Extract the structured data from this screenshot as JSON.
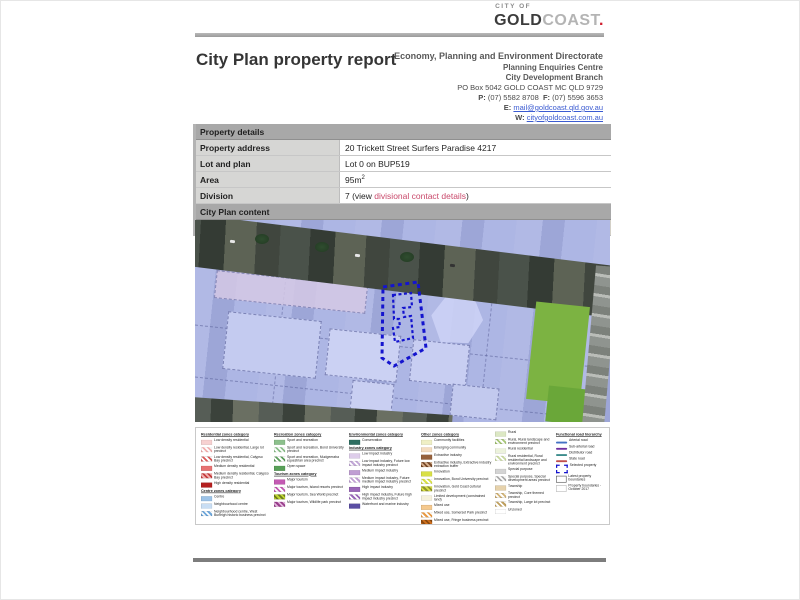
{
  "logo": {
    "city_of": "CITY OF",
    "gold": "GOLD",
    "coast": "COAST",
    "dot": "."
  },
  "header": {
    "title": "City Plan property report",
    "directorate": "Economy, Planning and Environment Directorate",
    "centre": "Planning Enquiries Centre",
    "branch": "City Development Branch",
    "po_box": "PO Box 5042 GOLD COAST MC QLD 9729",
    "phone_label": "P:",
    "phone": "(07) 5582 8708",
    "fax_label": "F:",
    "fax": "(07) 5596 3653",
    "email_label": "E:",
    "email": "mail@goldcoast.qld.gov.au",
    "web_label": "W:",
    "web": "cityofgoldcoast.com.au"
  },
  "property_details": {
    "section_title": "Property details",
    "rows": [
      {
        "label": "Property address",
        "value": "20 Trickett Street Surfers Paradise 4217"
      },
      {
        "label": "Lot and plan",
        "value": "Lot 0 on BUP519"
      },
      {
        "label": "Area",
        "value": "95m",
        "sup": "2"
      },
      {
        "label": "Division",
        "prefix": "7 (view ",
        "link": "divisional contact details",
        "suffix": ")"
      }
    ]
  },
  "sections": {
    "city_plan_content": "City Plan content",
    "zone_map": "Zone map"
  },
  "map_colors": {
    "zone_overlay": "#A8B1E2",
    "open_space_green": "#7CB342",
    "selected_property_outline": "#1414CE",
    "aerial_road": "#3B423B"
  },
  "legend": {
    "columns": [
      {
        "sections": [
          {
            "header": "Residential zones category",
            "items": [
              {
                "label": "Low density residential",
                "swatch": {
                  "type": "solid",
                  "color": "#F7D1D1"
                }
              },
              {
                "label": "Low density residential, Large lot precinct",
                "swatch": {
                  "type": "stripes",
                  "color": "#F2B0B0",
                  "color2": "#FFFFFF"
                }
              },
              {
                "label": "Low density residential, Calypso Bay precinct",
                "swatch": {
                  "type": "stripes",
                  "color": "#D85A5A",
                  "color2": "#FFFFFF"
                }
              },
              {
                "label": "Medium density residential",
                "swatch": {
                  "type": "solid",
                  "color": "#E87272"
                }
              },
              {
                "label": "Medium density residential, Calypso Bay precinct",
                "swatch": {
                  "type": "stripes",
                  "color": "#C43F3F",
                  "color2": "#F3B0B0"
                }
              },
              {
                "label": "High density residential",
                "swatch": {
                  "type": "solid",
                  "color": "#B42020"
                }
              }
            ]
          },
          {
            "header": "Centre zones category",
            "items": [
              {
                "label": "Centre",
                "swatch": {
                  "type": "solid",
                  "color": "#9CC3E8"
                }
              },
              {
                "label": "Neighbourhood centre",
                "swatch": {
                  "type": "solid",
                  "color": "#C9DEF4"
                }
              },
              {
                "label": "Neighbourhood centre, West Burleigh historic business precinct",
                "swatch": {
                  "type": "stripes",
                  "color": "#6FA8DC",
                  "color2": "#FFFFFF"
                }
              }
            ]
          }
        ]
      },
      {
        "sections": [
          {
            "header": "Recreation zones category",
            "items": [
              {
                "label": "Sport and recreation",
                "swatch": {
                  "type": "solid",
                  "color": "#8CC08C"
                }
              },
              {
                "label": "Sport and recreation, Bond University precinct",
                "swatch": {
                  "type": "stripes",
                  "color": "#8CC08C",
                  "color2": "#FFFFFF"
                }
              },
              {
                "label": "Sport and recreation, Mudgeeraba equestrian area precinct",
                "swatch": {
                  "type": "stripes",
                  "color": "#5E9E5E",
                  "color2": "#FFFFFF"
                }
              },
              {
                "label": "Open space",
                "swatch": {
                  "type": "solid",
                  "color": "#58A058"
                }
              }
            ]
          },
          {
            "header": "Tourism zones category",
            "items": [
              {
                "label": "Major tourism",
                "swatch": {
                  "type": "solid",
                  "color": "#C45AB3"
                }
              },
              {
                "label": "Major tourism, Island resorts precinct",
                "swatch": {
                  "type": "stripes",
                  "color": "#C45AB3",
                  "color2": "#FFFFFF"
                }
              },
              {
                "label": "Major tourism, Sea World precinct",
                "swatch": {
                  "type": "stripes",
                  "color": "#BFD730",
                  "color2": "#6E7B1F"
                }
              },
              {
                "label": "Major tourism, Wildlife park precinct",
                "swatch": {
                  "type": "stripes",
                  "color": "#993D8C",
                  "color2": "#E3B6DC"
                }
              }
            ]
          }
        ]
      },
      {
        "sections": [
          {
            "header": "Environmental zones category",
            "items": [
              {
                "label": "Conservation",
                "swatch": {
                  "type": "solid",
                  "color": "#2F6F62"
                }
              }
            ]
          },
          {
            "header": "Industry zones category",
            "items": [
              {
                "label": "Low impact industry",
                "swatch": {
                  "type": "solid",
                  "color": "#DECDEA"
                }
              },
              {
                "label": "Low impact industry, Future low impact industry precinct",
                "swatch": {
                  "type": "stripes",
                  "color": "#C3A8D8",
                  "color2": "#FFFFFF"
                }
              },
              {
                "label": "Medium impact industry",
                "swatch": {
                  "type": "solid",
                  "color": "#C09ED3"
                }
              },
              {
                "label": "Medium impact industry, Future medium impact industry precinct",
                "swatch": {
                  "type": "stripes",
                  "color": "#C09ED3",
                  "color2": "#FFFFFF"
                }
              },
              {
                "label": "High impact industry",
                "swatch": {
                  "type": "solid",
                  "color": "#9A66B8"
                }
              },
              {
                "label": "High impact industry, Future high impact industry precinct",
                "swatch": {
                  "type": "stripes",
                  "color": "#9A66B8",
                  "color2": "#FFFFFF"
                }
              },
              {
                "label": "Waterfront and marine industry",
                "swatch": {
                  "type": "solid",
                  "color": "#5B4EA3"
                }
              }
            ]
          }
        ]
      },
      {
        "sections": [
          {
            "header": "Other zones category",
            "items": [
              {
                "label": "Community facilities",
                "swatch": {
                  "type": "solid",
                  "color": "#EFEFC5"
                }
              },
              {
                "label": "Emerging community",
                "swatch": {
                  "type": "solid",
                  "color": "#F4DCC0"
                }
              },
              {
                "label": "Extractive industry",
                "swatch": {
                  "type": "solid",
                  "color": "#96613C"
                }
              },
              {
                "label": "Extractive industry, Extractive industry extraction buffer",
                "swatch": {
                  "type": "stripes",
                  "color": "#7B4B2A",
                  "color2": "#D8B28F"
                }
              },
              {
                "label": "Innovation",
                "swatch": {
                  "type": "solid",
                  "color": "#D9E046"
                }
              },
              {
                "label": "Innovation, Bond University precinct",
                "swatch": {
                  "type": "stripes",
                  "color": "#D9E046",
                  "color2": "#FFFFFF"
                }
              },
              {
                "label": "Innovation, Gold Coast cultural precinct",
                "swatch": {
                  "type": "stripes",
                  "color": "#8F942B",
                  "color2": "#D9E046"
                }
              },
              {
                "label": "Limited development (constrained land)",
                "swatch": {
                  "type": "solid",
                  "color": "#F5F1DC"
                }
              },
              {
                "label": "Mixed use",
                "swatch": {
                  "type": "solid",
                  "color": "#F5C98E"
                }
              },
              {
                "label": "Mixed use, Somerset Park precinct",
                "swatch": {
                  "type": "stripes",
                  "color": "#E89A45",
                  "color2": "#FFFFFF"
                }
              },
              {
                "label": "Mixed use, Fringe business precinct",
                "swatch": {
                  "type": "stripes",
                  "color": "#D2711E",
                  "color2": "#8C4A10"
                }
              }
            ]
          }
        ]
      },
      {
        "sections": [
          {
            "header": null,
            "items": [
              {
                "label": "Rural",
                "swatch": {
                  "type": "solid",
                  "color": "#DCE8C4"
                }
              },
              {
                "label": "Rural, Rural landscape and environment precinct",
                "swatch": {
                  "type": "stripes",
                  "color": "#A8C878",
                  "color2": "#FFFFFF"
                }
              },
              {
                "label": "Rural residential",
                "swatch": {
                  "type": "solid",
                  "color": "#ECF2DC"
                }
              },
              {
                "label": "Rural residential, Rural residential landscape and environment precinct",
                "swatch": {
                  "type": "stripes",
                  "color": "#C8D8A0",
                  "color2": "#FFFFFF"
                }
              },
              {
                "label": "Special purpose",
                "swatch": {
                  "type": "solid",
                  "color": "#D4D4D4"
                }
              },
              {
                "label": "Special purpose, Special development areas precinct",
                "swatch": {
                  "type": "stripes",
                  "color": "#ABABAB",
                  "color2": "#FFFFFF"
                }
              },
              {
                "label": "Township",
                "swatch": {
                  "type": "solid",
                  "color": "#E6D2AC"
                }
              },
              {
                "label": "Township, Core themed precinct",
                "swatch": {
                  "type": "stripes",
                  "color": "#D2B478",
                  "color2": "#FFFFFF"
                }
              },
              {
                "label": "Township, Large lot precinct",
                "swatch": {
                  "type": "stripes",
                  "color": "#BFA05F",
                  "color2": "#FFFFFF"
                }
              },
              {
                "label": "Unzoned",
                "swatch": {
                  "type": "solid",
                  "color": "#FFFFFF"
                }
              }
            ]
          }
        ]
      },
      {
        "sections": [
          {
            "header": "Functional road hierarchy",
            "items": [
              {
                "label": "Arterial road",
                "swatch": {
                  "type": "line",
                  "color": "#4472C4"
                }
              },
              {
                "label": "Sub-arterial road",
                "swatch": {
                  "type": "line",
                  "color": "#7030A0"
                }
              },
              {
                "label": "Distributor road",
                "swatch": {
                  "type": "line",
                  "color": "#3C8C8C"
                }
              },
              {
                "label": "State road",
                "swatch": {
                  "type": "line",
                  "color": "#C0504D"
                }
              },
              {
                "label": "Selected property",
                "swatch": {
                  "type": "dashed-rect",
                  "color": "#1414CE"
                }
              },
              {
                "label": "Latest property boundaries",
                "swatch": {
                  "type": "outline-rect",
                  "color": "#555555"
                }
              },
              {
                "label": "Property boundaries - October 2017",
                "swatch": {
                  "type": "outline-rect",
                  "color": "#BBBBBB"
                }
              }
            ]
          }
        ]
      }
    ]
  }
}
